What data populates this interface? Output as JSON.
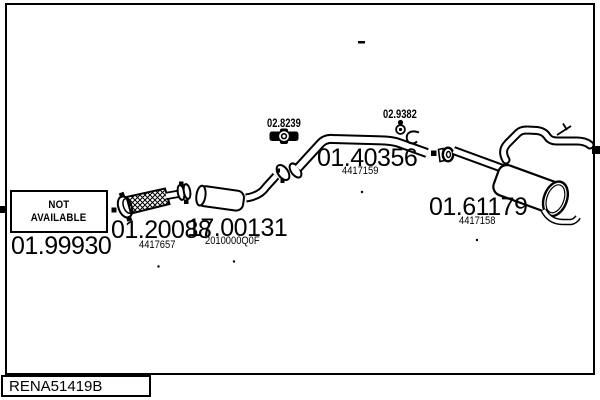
{
  "colors": {
    "background": "#ffffff",
    "line": "#000000"
  },
  "frame_code": "RENA51419B",
  "not_available": {
    "line1": "NOT",
    "line2": "AVAILABLE"
  },
  "parts": {
    "front_pipe": {
      "part_number": "01.99930"
    },
    "flex_pipe": {
      "part_number": "01.20088",
      "oe_ref": "4417657"
    },
    "catalytic_converter": {
      "part_number": "17.00131",
      "oe_ref": "2010000Q0F"
    },
    "centre_pipe": {
      "part_number": "01.40356",
      "oe_ref": "4417159"
    },
    "rear_silencer": {
      "part_number": "01.61179",
      "oe_ref": "4417158"
    },
    "clamp": {
      "part_number": "02.8239"
    },
    "rubber_mounting": {
      "part_number": "02.9382"
    }
  }
}
